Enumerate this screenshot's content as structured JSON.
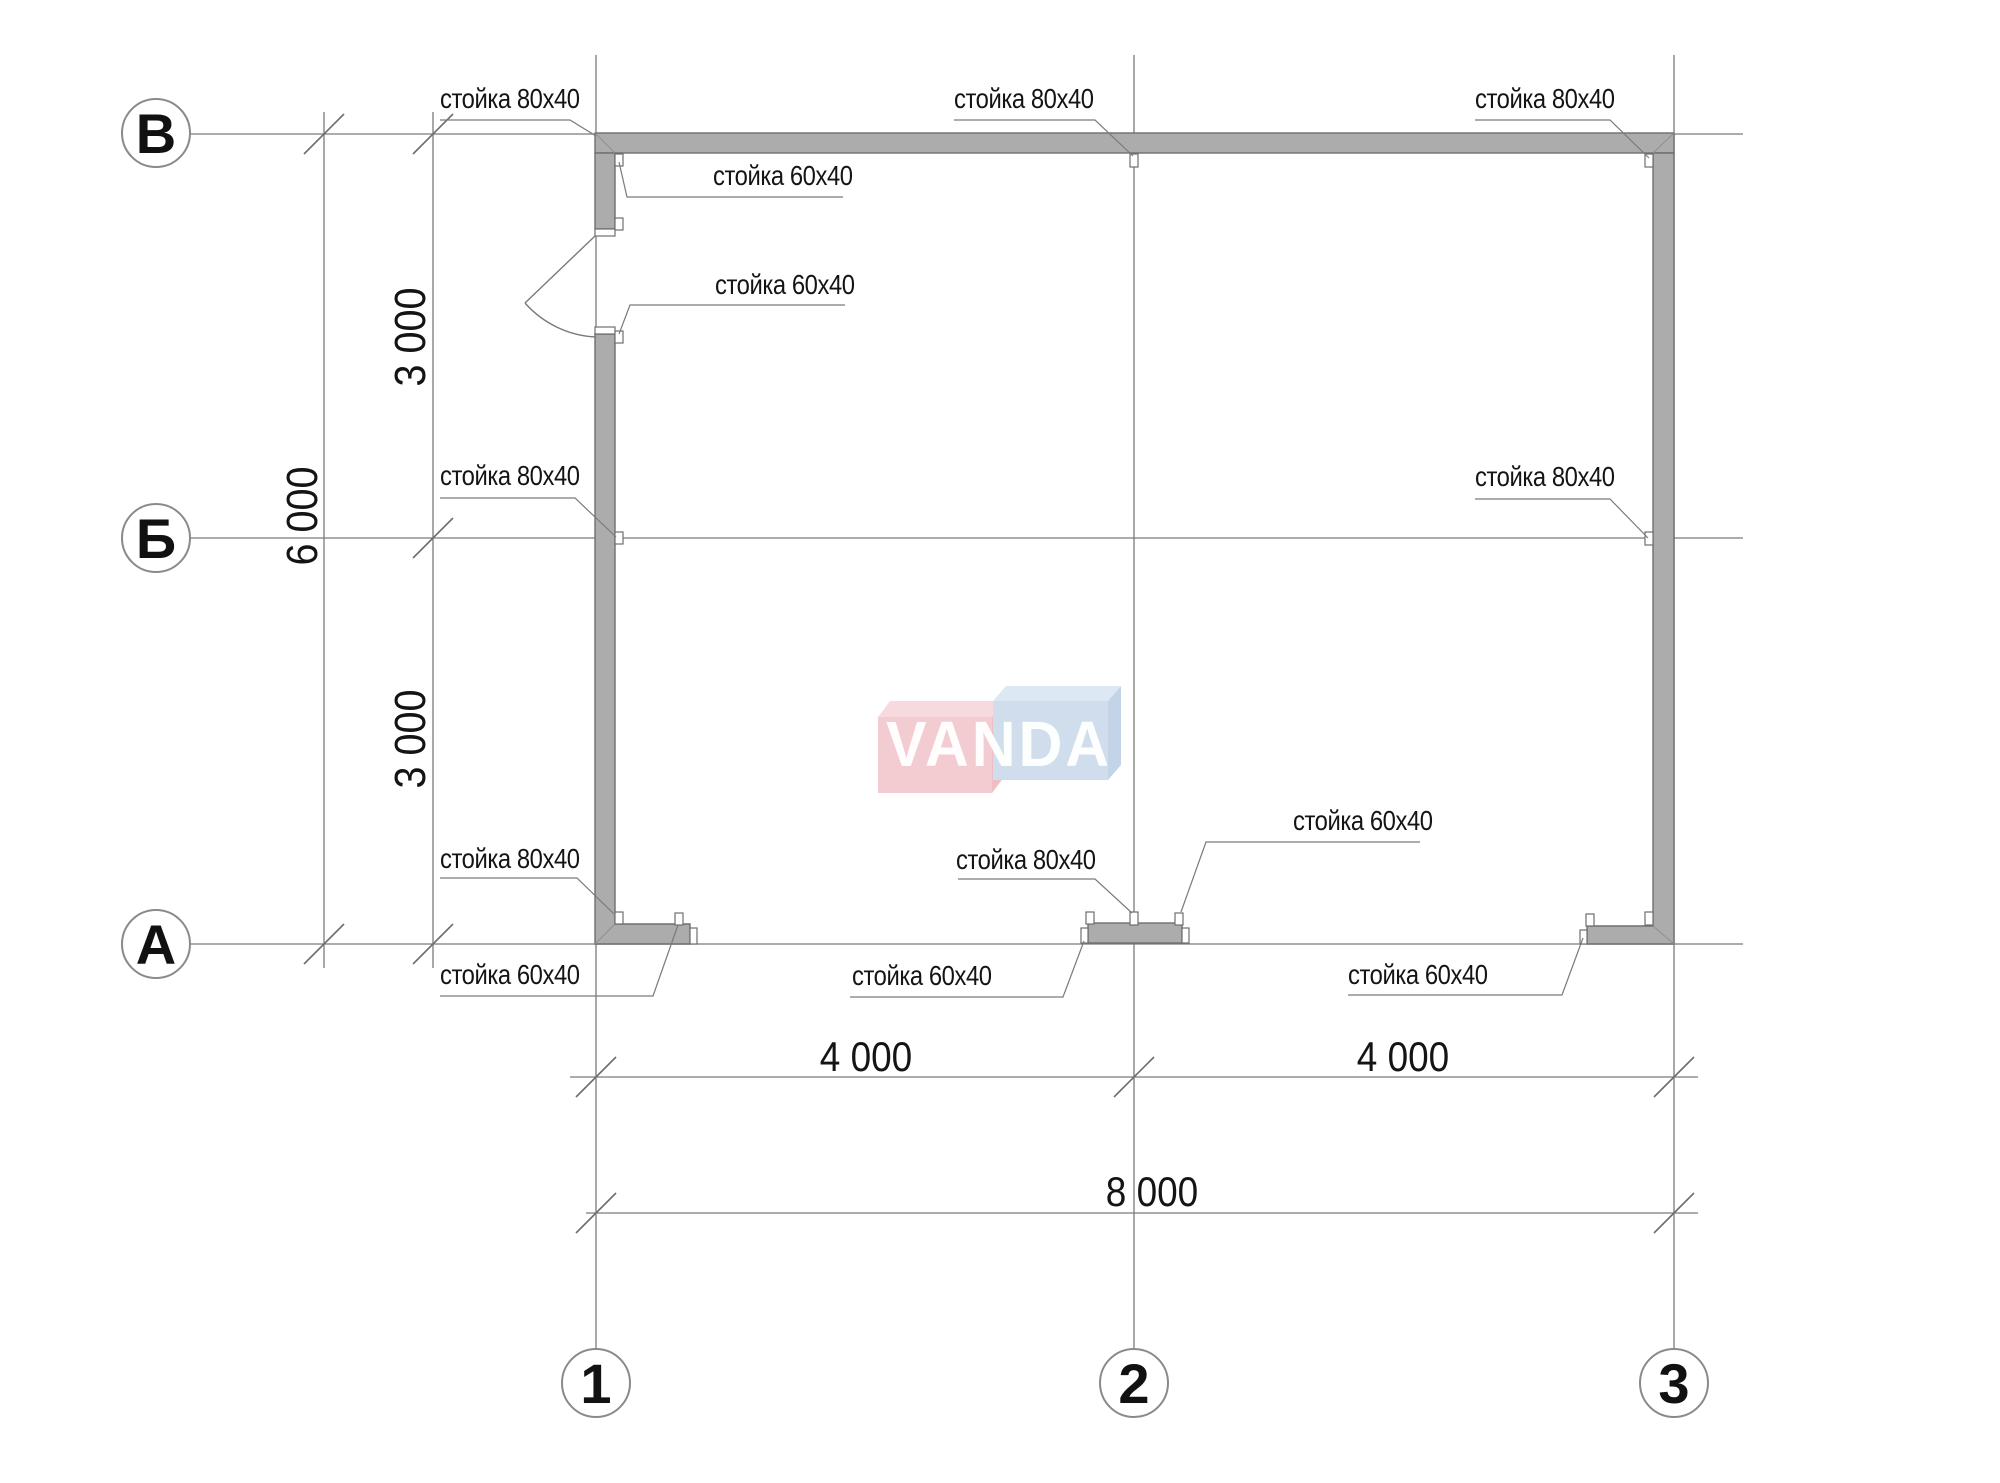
{
  "drawing_type": "floor-plan",
  "colors": {
    "background": "#ffffff",
    "wall_fill": "#acacac",
    "wall_edge": "#6f6f6f",
    "line": "#7a7a7a",
    "text": "#141414",
    "watermark_pink": "#f3ccd1",
    "watermark_blue": "#cfdded"
  },
  "grid": {
    "rows": [
      {
        "label": "В"
      },
      {
        "label": "Б"
      },
      {
        "label": "А"
      }
    ],
    "cols": [
      {
        "label": "1"
      },
      {
        "label": "2"
      },
      {
        "label": "3"
      }
    ]
  },
  "dims": {
    "h1": "4 000",
    "h2": "4 000",
    "h_total": "8 000",
    "v1": "3 000",
    "v2": "3 000",
    "v_total": "6 000"
  },
  "labels": {
    "tl80": "стойка 80x40",
    "tm80": "стойка 80x40",
    "tr80": "стойка 80x40",
    "door60a": "стойка 60x40",
    "door60b": "стойка 60x40",
    "lb80": "стойка 80x40",
    "rb80": "стойка 80x40",
    "bl80": "стойка 80x40",
    "bl60": "стойка 60x40",
    "bm80": "стойка 80x40",
    "bm60t": "стойка 60x40",
    "bm60b": "стойка 60x40",
    "br60": "стойка 60x40"
  },
  "watermark": {
    "text": "VANDA"
  }
}
